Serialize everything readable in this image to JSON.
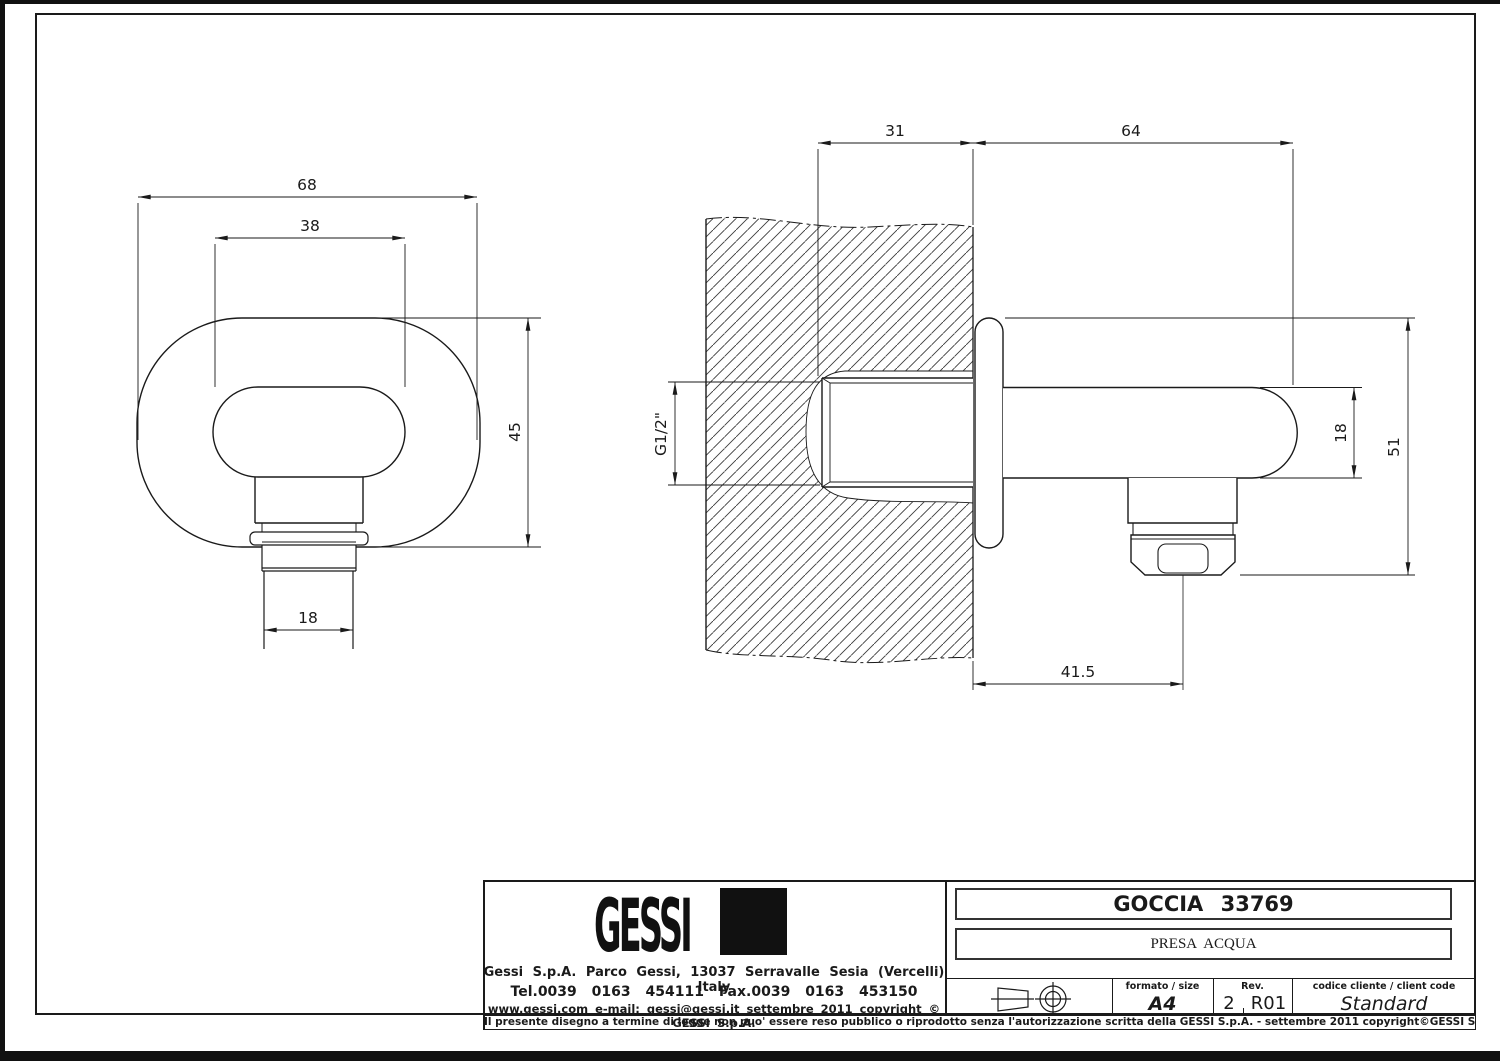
{
  "ink": "#1a1a1a",
  "dims": {
    "front_width": "68",
    "front_inner_width": "38",
    "front_height": "45",
    "front_outlet_width": "18",
    "side_wall_depth": "31",
    "side_projection": "64",
    "side_thread": "G1/2\"",
    "side_body_diameter": "18",
    "side_total_height": "51",
    "side_outlet_offset": "41.5"
  },
  "title_block": {
    "logo_text": "GESSI",
    "address": "Gessi S.p.A. Parco Gessi, 13037 Serravalle Sesia (Vercelli) Italy",
    "phone": "Tel.0039 0163 454111 Fax.0039 0163 453150",
    "web_line": "www.gessi.com e-mail: gessi@gessi.it settembre 2011 copyright © GESSI S.p.A.",
    "product_name": "GOCCIA 33769",
    "product_type": "PRESA ACQUA",
    "format_label": "formato / size",
    "format_value": "A4",
    "rev_label": "Rev.",
    "rev_number": "2",
    "rev_code": "R01",
    "client_code_label": "codice cliente / client code",
    "client_code_value": "Standard",
    "legal_notice": "Il presente disegno a termine di legge non puo' essere reso pubblico o riprodotto senza l'autorizzazione scritta della GESSI S.p.A. - settembre 2011 copyright©GESSI S.p.A."
  }
}
